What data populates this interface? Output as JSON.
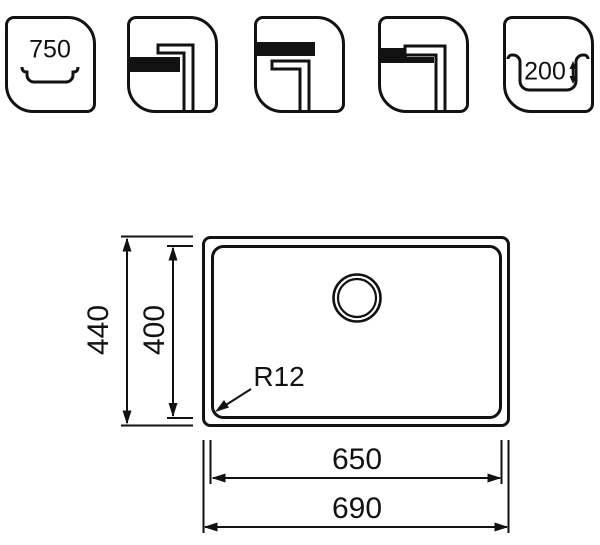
{
  "icons": {
    "min_cabinet_width": {
      "label": "750"
    },
    "bowl_depth": {
      "label": "200"
    }
  },
  "dimensions": {
    "outer_height": "440",
    "inner_height": "400",
    "corner_radius": "R12",
    "inner_width": "650",
    "outer_width": "690"
  },
  "colors": {
    "line": "#121212",
    "background": "#ffffff"
  }
}
